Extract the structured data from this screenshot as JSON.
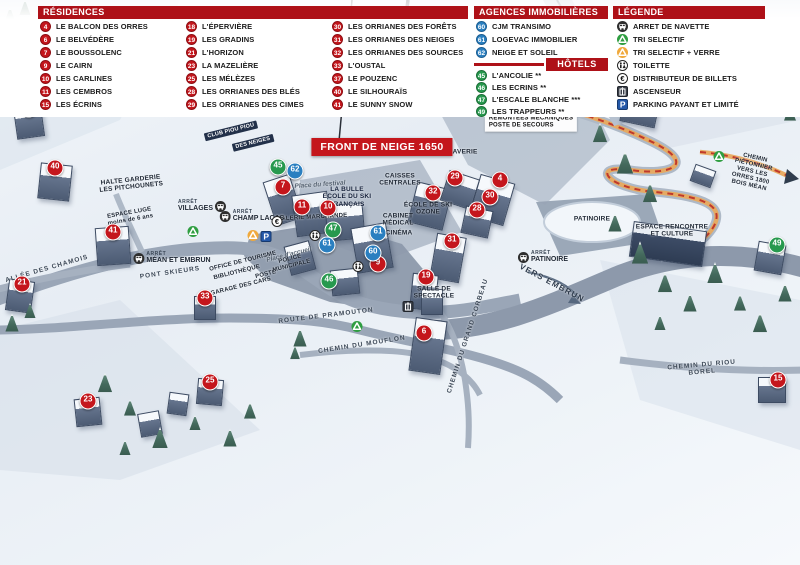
{
  "map": {
    "banner": {
      "text": "FRONT DE NEIGE 1650"
    },
    "stop_caption": "ARRÊT",
    "labels": [
      {
        "text": "ESPACE LUGE\nà partir de 7 ans",
        "x": 311,
        "y": 49,
        "r": -68,
        "cls": "tiny"
      },
      {
        "text": "TÉLÉSKI DU PIC VERT",
        "x": 352,
        "y": 78,
        "r": -76,
        "cls": "tiny"
      },
      {
        "text": "L'ORRIAN EXPRESS\nLUGE",
        "x": 397,
        "y": 79,
        "r": 0,
        "cls": "small"
      },
      {
        "text": "TÉLÉSIÈGE DU BOIS MÉAN",
        "x": 570,
        "y": 52,
        "r": 55,
        "cls": "tiny"
      },
      {
        "text": "SEMLORE\nREMONTÉES MÉCANIQUES\nPOSTE DE SECOURS",
        "x": 531,
        "y": 119,
        "r": 0,
        "cls": "whitebox"
      },
      {
        "text": "HALTE GARDERIE\nLES PITCHOUNETS",
        "x": 131,
        "y": 184,
        "r": -6,
        "cls": "small"
      },
      {
        "text": "CLUB PIOU PIOU",
        "x": 231,
        "y": 131,
        "r": -14,
        "cls": "darkbox"
      },
      {
        "text": "DES NEIGES",
        "x": 253,
        "y": 143,
        "r": -14,
        "cls": "darkbox"
      },
      {
        "text": "ESPACE LUGE\nmoins de 6 ans",
        "x": 130,
        "y": 217,
        "r": -10,
        "cls": "tiny"
      },
      {
        "text": "VILLAGES",
        "x": 0,
        "y": 0,
        "r": 0,
        "cls": "hidden"
      },
      {
        "text": "LA BULLE\nÉCOLE DU SKI\nFRANÇAIS",
        "x": 347,
        "y": 197,
        "r": 0,
        "cls": "navy"
      },
      {
        "text": "Place du festival",
        "x": 320,
        "y": 185,
        "r": -4,
        "cls": "it"
      },
      {
        "text": "GALERIE MARCHANDE",
        "x": 312,
        "y": 218,
        "r": -3,
        "cls": "tiny"
      },
      {
        "text": "CAISSES\nCENTRALES",
        "x": 400,
        "y": 180,
        "r": 0,
        "cls": "small"
      },
      {
        "text": "CABINET\nMÉDICAL",
        "x": 398,
        "y": 220,
        "r": 0,
        "cls": "small"
      },
      {
        "text": "CINÉMA",
        "x": 399,
        "y": 233,
        "r": 0,
        "cls": "small"
      },
      {
        "text": "ÉCOLE DE SKI\nOZONE",
        "x": 428,
        "y": 209,
        "r": 0,
        "cls": "small"
      },
      {
        "text": "LAVERIE",
        "x": 463,
        "y": 152,
        "r": 0,
        "cls": "small"
      },
      {
        "text": "Place d'accueil",
        "x": 289,
        "y": 255,
        "r": -14,
        "cls": "it"
      },
      {
        "text": "OFFICE DE TOURISME",
        "x": 243,
        "y": 262,
        "r": -14,
        "cls": "tiny"
      },
      {
        "text": "BIBLIOTHÈQUE",
        "x": 237,
        "y": 273,
        "r": -14,
        "cls": "tiny"
      },
      {
        "text": "POSTE",
        "x": 266,
        "y": 275,
        "r": -14,
        "cls": "tiny"
      },
      {
        "text": "GARAGE DES CARS",
        "x": 241,
        "y": 287,
        "r": -14,
        "cls": "tiny"
      },
      {
        "text": "POLICE\nMUNICIPALE",
        "x": 291,
        "y": 263,
        "r": -14,
        "cls": "tiny"
      },
      {
        "text": "SALLE DE\nSPECTACLE",
        "x": 434,
        "y": 293,
        "r": 0,
        "cls": "small"
      },
      {
        "text": "ROUTE DE PRAMOUTON",
        "x": 326,
        "y": 316,
        "r": -7,
        "cls": "road"
      },
      {
        "text": "CHEMIN DU MOUFLON",
        "x": 362,
        "y": 345,
        "r": -9,
        "cls": "road"
      },
      {
        "text": "CHEMIN DU GRAND CORBEAU",
        "x": 468,
        "y": 336,
        "r": -72,
        "cls": "road"
      },
      {
        "text": "VERS EMBRUN",
        "x": 552,
        "y": 283,
        "r": 28,
        "cls": "roadbig"
      },
      {
        "text": "PATINOIRE",
        "x": 592,
        "y": 219,
        "r": 0,
        "cls": "small"
      },
      {
        "text": "ESPACE RENCONTRE\nET CULTURE",
        "x": 672,
        "y": 231,
        "r": 0,
        "cls": "small"
      },
      {
        "text": "CHEMIN PIÉTONNIER\nVERS LES ORRES 1800\nBOIS MÉAN",
        "x": 752,
        "y": 172,
        "r": 13,
        "cls": "tiny"
      },
      {
        "text": "CHEMIN DU RIOU BOREL",
        "x": 702,
        "y": 369,
        "r": -5,
        "cls": "road"
      },
      {
        "text": "ALLÉE DES CHAMOIS",
        "x": 47,
        "y": 269,
        "r": -16,
        "cls": "road"
      },
      {
        "text": "PONT SKIEURS",
        "x": 170,
        "y": 273,
        "r": -8,
        "cls": "road"
      }
    ],
    "stops": [
      {
        "name": "VILLAGES",
        "x": 202,
        "y": 206,
        "iconSide": "right"
      },
      {
        "name": "CHAMP LACAS",
        "x": 252,
        "y": 216,
        "iconSide": "left"
      },
      {
        "name": "MÉAN ET EMBRUN",
        "x": 172,
        "y": 258,
        "iconSide": "left"
      },
      {
        "name": "PATINOIRE",
        "x": 543,
        "y": 257,
        "iconSide": "left"
      }
    ],
    "markers": [
      {
        "n": "18",
        "c": "red",
        "x": 29,
        "y": 109
      },
      {
        "n": "40",
        "c": "red",
        "x": 55,
        "y": 168
      },
      {
        "n": "41",
        "c": "red",
        "x": 113,
        "y": 232
      },
      {
        "n": "21",
        "c": "red",
        "x": 22,
        "y": 284
      },
      {
        "n": "33",
        "c": "red",
        "x": 205,
        "y": 298
      },
      {
        "n": "23",
        "c": "red",
        "x": 88,
        "y": 401
      },
      {
        "n": "25",
        "c": "red",
        "x": 210,
        "y": 382
      },
      {
        "n": "7",
        "c": "red",
        "x": 283,
        "y": 187
      },
      {
        "n": "11",
        "c": "red",
        "x": 302,
        "y": 207
      },
      {
        "n": "10",
        "c": "red",
        "x": 328,
        "y": 208
      },
      {
        "n": "9",
        "c": "red",
        "x": 378,
        "y": 264
      },
      {
        "n": "29",
        "c": "red",
        "x": 455,
        "y": 178
      },
      {
        "n": "32",
        "c": "red",
        "x": 433,
        "y": 193
      },
      {
        "n": "4",
        "c": "red",
        "x": 500,
        "y": 180
      },
      {
        "n": "30",
        "c": "red",
        "x": 490,
        "y": 197
      },
      {
        "n": "28",
        "c": "red",
        "x": 477,
        "y": 210
      },
      {
        "n": "31",
        "c": "red",
        "x": 452,
        "y": 241
      },
      {
        "n": "19",
        "c": "red",
        "x": 426,
        "y": 277
      },
      {
        "n": "6",
        "c": "red",
        "x": 424,
        "y": 333
      },
      {
        "n": "37",
        "c": "red",
        "x": 637,
        "y": 98
      },
      {
        "n": "15",
        "c": "red",
        "x": 778,
        "y": 380
      },
      {
        "n": "45",
        "c": "green",
        "x": 278,
        "y": 167
      },
      {
        "n": "47",
        "c": "green",
        "x": 333,
        "y": 230
      },
      {
        "n": "46",
        "c": "green",
        "x": 329,
        "y": 281
      },
      {
        "n": "49",
        "c": "green",
        "x": 777,
        "y": 245
      },
      {
        "n": "62",
        "c": "blue",
        "x": 295,
        "y": 171
      },
      {
        "n": "61",
        "c": "blue",
        "x": 378,
        "y": 233
      },
      {
        "n": "61",
        "c": "blue",
        "x": 327,
        "y": 245
      },
      {
        "n": "60",
        "c": "blue",
        "x": 373,
        "y": 253
      }
    ],
    "icons": [
      {
        "t": "recycle",
        "x": 193,
        "y": 233
      },
      {
        "t": "recycle",
        "x": 357,
        "y": 328
      },
      {
        "t": "recycle",
        "x": 719,
        "y": 158
      },
      {
        "t": "triverre",
        "x": 253,
        "y": 237
      },
      {
        "t": "parking",
        "x": 266,
        "y": 238
      },
      {
        "t": "euro",
        "x": 277,
        "y": 223
      },
      {
        "t": "wc",
        "x": 315,
        "y": 237
      },
      {
        "t": "wc",
        "x": 358,
        "y": 268
      },
      {
        "t": "lift",
        "x": 408,
        "y": 308
      }
    ]
  },
  "legend": {
    "residences": {
      "title": "RÉSIDENCES",
      "columns": [
        [
          {
            "n": "4",
            "label": "LE BALCON DES ORRES"
          },
          {
            "n": "6",
            "label": "LE BELVÉDÈRE"
          },
          {
            "n": "7",
            "label": "LE BOUSSOLENC"
          },
          {
            "n": "9",
            "label": "LE CAIRN"
          },
          {
            "n": "10",
            "label": "LES CARLINES"
          },
          {
            "n": "11",
            "label": "LES CEMBROS"
          },
          {
            "n": "15",
            "label": "LES ÉCRINS"
          }
        ],
        [
          {
            "n": "18",
            "label": "L'ÉPERVIÈRE"
          },
          {
            "n": "19",
            "label": "LES GRADINS"
          },
          {
            "n": "21",
            "label": "L'HORIZON"
          },
          {
            "n": "23",
            "label": "LA MAZELIÈRE"
          },
          {
            "n": "25",
            "label": "LES MÉLÈZES"
          },
          {
            "n": "28",
            "label": "LES ORRIANES DES BLÉS"
          },
          {
            "n": "29",
            "label": "LES ORRIANES DES CIMES"
          }
        ],
        [
          {
            "n": "30",
            "label": "LES ORRIANES DES FORÊTS"
          },
          {
            "n": "31",
            "label": "LES ORRIANES DES NEIGES"
          },
          {
            "n": "32",
            "label": "LES ORRIANES DES SOURCES"
          },
          {
            "n": "33",
            "label": "L'OUSTAL"
          },
          {
            "n": "37",
            "label": "LE POUZENC"
          },
          {
            "n": "40",
            "label": "LE SILHOURAÏS"
          },
          {
            "n": "41",
            "label": "LE SUNNY SNOW"
          }
        ]
      ]
    },
    "agences": {
      "title": "AGENCES IMMOBILIÈRES",
      "items": [
        {
          "n": "60",
          "label": "CJM TRANSIMO"
        },
        {
          "n": "61",
          "label": "LOGEVAC IMMOBILIER"
        },
        {
          "n": "62",
          "label": "NEIGE ET SOLEIL"
        }
      ]
    },
    "hotels": {
      "title": "HÔTELS",
      "items": [
        {
          "n": "45",
          "label": "L'ANCOLIE **"
        },
        {
          "n": "46",
          "label": "LES ECRINS **"
        },
        {
          "n": "47",
          "label": "L'ESCALE BLANCHE ***"
        },
        {
          "n": "49",
          "label": "LES TRAPPEURS **"
        }
      ]
    },
    "legende": {
      "title": "LÉGENDE",
      "items": [
        {
          "icon": "bus",
          "label": "ARRET DE NAVETTE"
        },
        {
          "icon": "recycle",
          "label": "TRI SELECTIF"
        },
        {
          "icon": "triverre",
          "label": "TRI SELECTIF + VERRE"
        },
        {
          "icon": "wc",
          "label": "TOILETTE"
        },
        {
          "icon": "euro",
          "label": "DISTRIBUTEUR DE BILLETS"
        },
        {
          "icon": "lift",
          "label": "ASCENSEUR"
        },
        {
          "icon": "parking",
          "label": "PARKING PAYANT ET LIMITÉ"
        }
      ]
    }
  },
  "colors": {
    "accent_red": "#c4161c",
    "header_red": "#ae1118",
    "marker_blue": "#2a7fc0",
    "marker_green": "#27994e",
    "trail_orange": "#e8a95e"
  }
}
